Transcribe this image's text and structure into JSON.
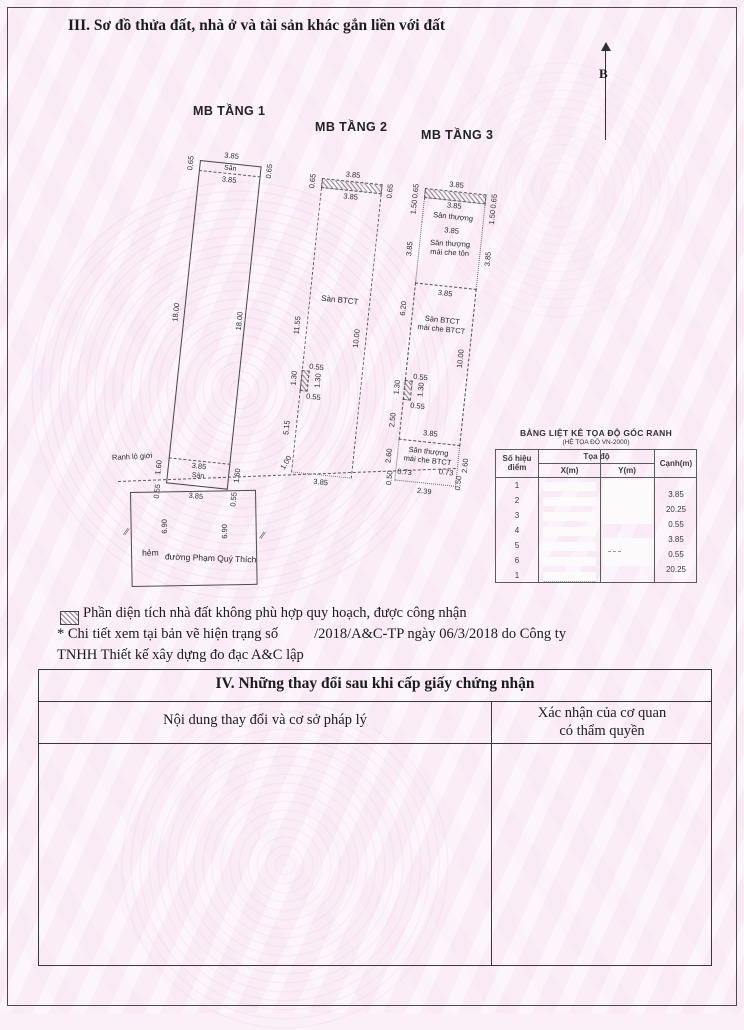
{
  "page": {
    "section3_title": "III. Sơ đồ thửa đất, nhà ở và tài sản khác gắn liền với đất",
    "north_label": "B"
  },
  "plans": {
    "t1": {
      "title": "MB TẦNG 1",
      "dim_top": "3.85",
      "dim_top_left": "0.65",
      "dim_top_right": "0.65",
      "label_san_top": "Sân",
      "dim_top_inner": "3.85",
      "dim_side_left": "18.00",
      "dim_side_right": "18.00",
      "label_ranh": "Ranh lộ giới",
      "dim_bottom_inner": "3.85",
      "label_san_bottom": "Sân",
      "dim_bottom_left": "1.60",
      "dim_bottom_right": "1.60",
      "dim_below_left": "0.55",
      "dim_below_right": "0.55",
      "dim_below": "3.85",
      "street": {
        "dim_left": "6.90",
        "dim_right": "6.90",
        "label_hem": "hẻm",
        "label_street": "đường Phạm Quý Thích"
      }
    },
    "t2": {
      "title": "MB TẦNG 2",
      "dim_top": "3.85",
      "dim_top_left": "0.65",
      "dim_top_right": "0.65",
      "dim_top_inner": "3.85",
      "dim_side_left": "11.55",
      "label_main": "Sàn BTCT",
      "dim_side_right": "10.00",
      "notch_top": "0.55",
      "notch_left": "1.30",
      "notch_right": "1.30",
      "notch_bottom": "0.55",
      "dim_side_left_lower": "5.15",
      "dim_bottom_left": "1.00",
      "dim_bottom": "3.85"
    },
    "t3": {
      "title": "MB TẦNG 3",
      "dim_top": "3.85",
      "dim_top_left": "0.65",
      "dim_top_right": "0.65",
      "dim_top_inner": "3.85",
      "label_terrace": "Sân thượng",
      "dim_terrace_left": "1.50",
      "dim_terrace_right": "1.50",
      "dim_terrace_width": "3.85",
      "label_ton_1": "Sân thượng",
      "label_ton_2": "mái che tôn",
      "dim_ton_left": "3.85",
      "dim_ton_right": "3.85",
      "dim_main_top": "3.85",
      "dim_main_left": "6.20",
      "label_main_1": "Sàn BTCT",
      "label_main_2": "mái che BTCT",
      "dim_main_right": "10.00",
      "notch_top": "0.55",
      "notch_left": "1.30",
      "notch_right": "1.30",
      "notch_bottom": "0.55",
      "dim_main_left_lower": "2.50",
      "dim_main_bottom": "3.85",
      "label_bt_1": "Sân thượng",
      "label_bt_2": "mái che BTCT",
      "dim_bt_left": "2.60",
      "dim_bt_right": "2.60",
      "dim_bt_l1": "0.73",
      "dim_bt_r1": "0.73",
      "dim_bt_l2": "0.50",
      "dim_bt_r2": "0.50",
      "dim_bt_bottom": "2.39"
    }
  },
  "coord_table": {
    "title": "BẢNG LIỆT KÊ TỌA ĐỘ GÓC RANH",
    "subtitle": "(HỆ TỌA ĐỘ VN-2000)",
    "col_point_1": "Số hiệu",
    "col_point_2": "điểm",
    "col_coords": "Tọa độ",
    "col_x": "X(m)",
    "col_y": "Y(m)",
    "col_edge": "Cạnh(m)",
    "points": [
      "1",
      "2",
      "3",
      "4",
      "5",
      "6",
      "1"
    ],
    "edges": [
      "3.85",
      "20.25",
      "0.55",
      "3.85",
      "0.55",
      "20.25"
    ]
  },
  "legend": {
    "text": "Phần diện tích nhà đất không phù hợp quy hoạch, được công nhận"
  },
  "note": {
    "part1": "* Chi tiết xem tại bản vẽ hiện trạng số",
    "part2": "/2018/A&C-TP ngày 06/3/2018 do Công ty",
    "line2": "TNHH Thiết kế xây dựng đo đạc A&C lập"
  },
  "section4": {
    "title": "IV. Những thay đổi sau khi cấp giấy chứng nhận",
    "col1": "Nội dung thay đổi và cơ sở pháp lý",
    "col2_1": "Xác nhận của cơ quan",
    "col2_2": "có thẩm quyền"
  }
}
